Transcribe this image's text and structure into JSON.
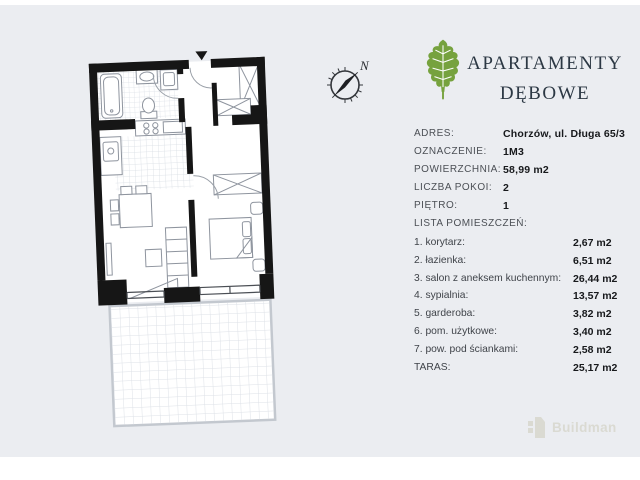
{
  "logo": {
    "line1": "APARTAMENTY",
    "line2": "DĘBOWE",
    "leaf_color": "#76a23e"
  },
  "compass": {
    "north_label": "N"
  },
  "details": {
    "rows": [
      {
        "label": "ADRES:",
        "value": "Chorzów, ul. Długa 65/3"
      },
      {
        "label": "OZNACZENIE:",
        "value": "1M3"
      },
      {
        "label": "POWIERZCHNIA:",
        "value": "58,99 m2"
      },
      {
        "label": "LICZBA POKOI:",
        "value": "2"
      },
      {
        "label": "PIĘTRO:",
        "value": "1"
      }
    ],
    "list_header": "LISTA POMIESZCZEŃ:",
    "rooms": [
      {
        "name": "1. korytarz:",
        "area": "2,67 m2"
      },
      {
        "name": "2. łazienka:",
        "area": "6,51 m2"
      },
      {
        "name": "3. salon z aneksem kuchennym:",
        "area": "26,44 m2"
      },
      {
        "name": "4. sypialnia:",
        "area": "13,57 m2"
      },
      {
        "name": "5. garderoba:",
        "area": "3,82 m2"
      },
      {
        "name": "6. pom. użytkowe:",
        "area": "3,40 m2"
      },
      {
        "name": "7. pow. pod ściankami:",
        "area": "2,58 m2"
      },
      {
        "name": "TARAS:",
        "area": "25,17 m2"
      }
    ]
  },
  "footer": {
    "brand": "Buildman"
  },
  "colors": {
    "background": "#ebedf1",
    "walls": "#161616",
    "furniture_line": "#8e949e",
    "title_text": "#2c3844",
    "brand_text": "#dadad2"
  }
}
